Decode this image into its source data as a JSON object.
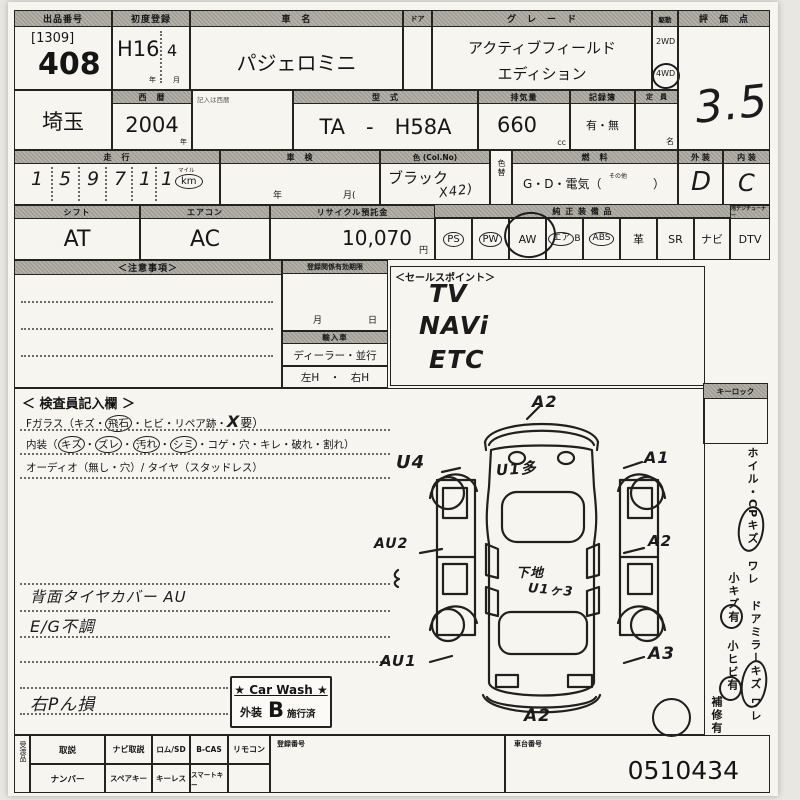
{
  "header": {
    "lot_label": "出品番号",
    "lot_bracket": "[1309]",
    "lot_number": "408",
    "reg_label": "初度登録",
    "reg_year": "H16",
    "reg_month": "4",
    "reg_year_unit": "年",
    "reg_month_unit": "月",
    "name_label": "車　名",
    "name_value": "パジェロミニ",
    "door_label": "ドア",
    "grade_label": "グ　レ　ー　ド",
    "grade_line1": "アクティブフィールド",
    "grade_line2": "エディション",
    "drive_label": "駆動",
    "drive_2wd": "2WD",
    "drive_4wd": "4WD",
    "score_label": "評　価　点",
    "score_value": "3.5"
  },
  "row2": {
    "prefecture": "埼玉",
    "year_label": "西　暦",
    "year_value": "2004",
    "year_unit": "年",
    "year_note": "記入は西暦",
    "model_label": "型　式",
    "model_value": "TA　-　H58A",
    "disp_label": "排気量",
    "disp_value": "660",
    "disp_unit": "cc",
    "records_label": "記録簿",
    "records_value": "有・無",
    "capacity_label": "定　員",
    "capacity_unit": "名"
  },
  "row3": {
    "mileage_label": "走　行",
    "mileage_digits": [
      "1",
      "5",
      "9",
      "7",
      "1",
      "1"
    ],
    "mile_label": "マイル",
    "km_label": "km",
    "shaken_label": "車　検",
    "shaken_year": "年",
    "shaken_month": "月(",
    "color_label": "色 (Col.No)",
    "color_value": "ブラック",
    "color_code": "X42)",
    "color_change": "色替",
    "fuel_label": "燃　料",
    "fuel_value": "G・D・電気（",
    "fuel_other": "その他",
    "fuel_close": "）",
    "ext_label": "外 装",
    "ext_value": "D",
    "int_label": "内 装",
    "int_value": "C"
  },
  "row4": {
    "shift_label": "シフト",
    "shift_value": "AT",
    "ac_label": "エアコン",
    "ac_value": "AC",
    "recycle_label": "リサイクル預託金",
    "recycle_value": "10,070",
    "recycle_unit": "円",
    "equip_label": "純 正 装 備 品",
    "tuner_label": "地デジチューナー",
    "equipment": [
      {
        "label": "PS",
        "mark": "printed-circle"
      },
      {
        "label": "PW",
        "mark": "printed-circle"
      },
      {
        "label": "AW",
        "mark": "hand-circle"
      },
      {
        "label": "エア",
        "label2": "B",
        "mark": "circle-on-first"
      },
      {
        "label": "ABS",
        "mark": "printed-circle"
      },
      {
        "label": "革",
        "mark": "none"
      },
      {
        "label": "SR",
        "mark": "none"
      },
      {
        "label": "ナビ",
        "mark": "none"
      },
      {
        "label": "DTV",
        "mark": "none"
      }
    ]
  },
  "middle": {
    "caution_label": "＜注意事項＞",
    "reg_valid_label": "登録関係有効期限",
    "reg_month": "月",
    "reg_day": "日",
    "import_label": "輸入車",
    "import_value": "ディーラー・並行",
    "handle_value": "左H　・　右H",
    "sales_label": "＜セールスポイント＞",
    "sales_points": [
      "TV",
      "NAVi",
      "ETC"
    ]
  },
  "inspection": {
    "title": "＜ 検査員記入欄 ＞",
    "glass_prefix": "Fガラス（キズ・",
    "glass_circled": "飛石",
    "glass_mid": "・ヒビ・リペア跡・",
    "glass_hand": "X",
    "glass_suffix": "要）",
    "interior_prefix": "内装（",
    "sep": "・",
    "interior_items": [
      "キズ",
      "ズレ",
      "汚れ",
      "シミ",
      "コゲ",
      "穴",
      "キレ",
      "破れ",
      "割れ"
    ],
    "interior_close": "）",
    "audio_line": "オーディオ（無し・穴）/ タイヤ（スタッドレス）",
    "notes": [
      "背面タイヤカバー AU",
      "E/G不調",
      "右Pん損"
    ]
  },
  "carwash": {
    "title": "★ Car Wash ★",
    "prefix": "外装",
    "grade": "B",
    "suffix": "施行済"
  },
  "sidebar": {
    "keylock_label": "キーロック",
    "items": [
      "ホイル・CPキズ",
      "ワレ",
      "小キズ有",
      "ドアミラーキズ",
      "ワレ",
      "小ヒビ有",
      "補修有"
    ]
  },
  "diagram": {
    "annotations": [
      {
        "text": "A2"
      },
      {
        "text": "U4"
      },
      {
        "text": "U1多"
      },
      {
        "text": "A1"
      },
      {
        "text": "AU2"
      },
      {
        "text": "A2"
      },
      {
        "text": "下地"
      },
      {
        "text": "U1ヶ3"
      },
      {
        "text": "AU1"
      },
      {
        "text": "A3"
      },
      {
        "text": "A2"
      }
    ]
  },
  "footer": {
    "handover_label": "受渡品",
    "row1": [
      "取説",
      "ナビ取説",
      "ロム/SD",
      "B-CAS",
      "リモコン"
    ],
    "row2": [
      "ナンバー",
      "スペアキー",
      "キーレス",
      "スマートキー"
    ],
    "regno_label": "登録番号",
    "chassis_label": "車台番号",
    "chassis_value": "0510434"
  }
}
